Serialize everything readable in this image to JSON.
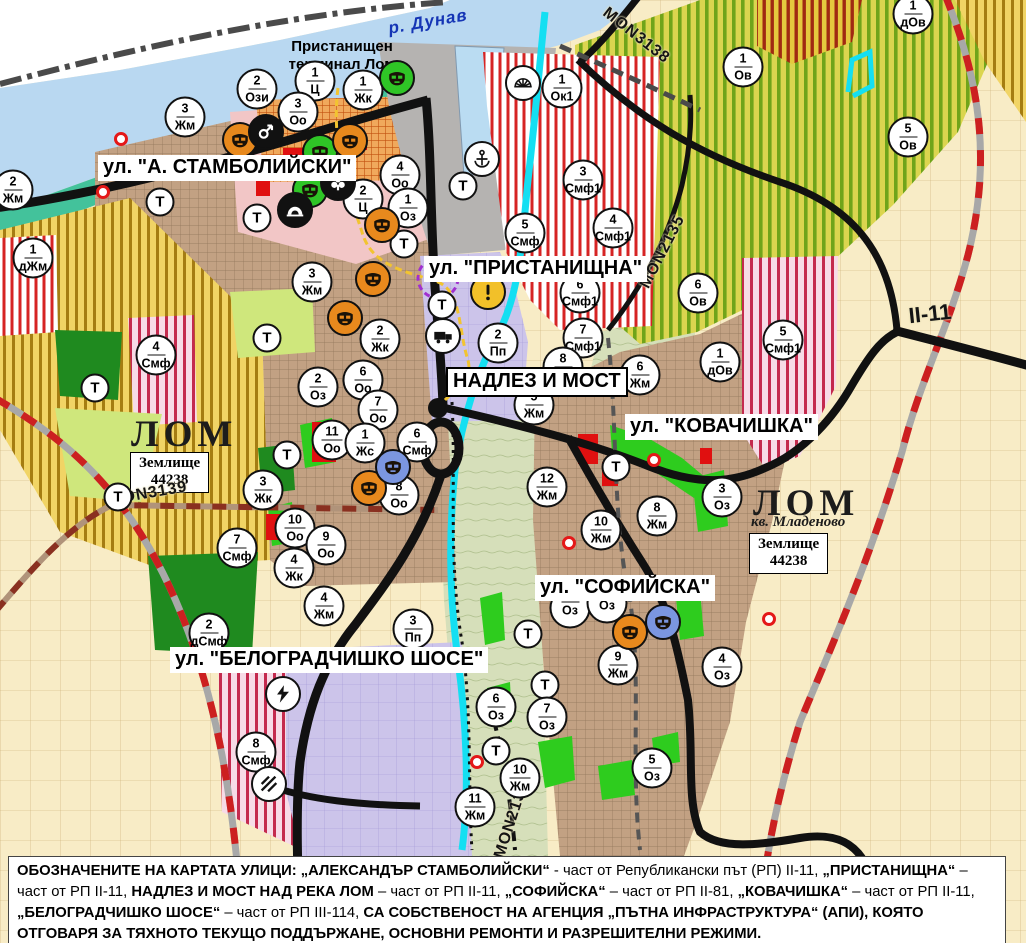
{
  "map": {
    "river_label": "р. Дунав",
    "port_terminal_label": "Пристанищен терминал Лом",
    "street_labels": [
      {
        "text": "ул. \"А. СТАМБОЛИЙСКИ\"",
        "x": 98,
        "y": 155,
        "boxed": false
      },
      {
        "text": "ул. \"ПРИСТАНИЩНА\"",
        "x": 424,
        "y": 256,
        "boxed": false
      },
      {
        "text": "НАДЛЕЗ И МОСТ",
        "x": 446,
        "y": 367,
        "boxed": true
      },
      {
        "text": "ул. \"КОВАЧИШКА\"",
        "x": 625,
        "y": 414,
        "boxed": false
      },
      {
        "text": "ул. \"СОФИЙСКА\"",
        "x": 535,
        "y": 575,
        "boxed": false
      },
      {
        "text": "ул. \"БЕЛОГРАДЧИШКО ШОСЕ\"",
        "x": 170,
        "y": 647,
        "boxed": false
      }
    ],
    "area_labels": [
      {
        "text": "ЛОМ",
        "x": 131,
        "y": 413
      },
      {
        "text": "ЛОМ",
        "x": 753,
        "y": 482
      }
    ],
    "sub_area_label": {
      "text": "кв. Младеново",
      "x": 751,
      "y": 514
    },
    "zemlishte_boxes": [
      {
        "line1": "Землище",
        "line2": "44238",
        "x": 130,
        "y": 452
      },
      {
        "line1": "Землище",
        "line2": "44238",
        "x": 749,
        "y": 533
      }
    ],
    "road_labels": [
      {
        "text": "MON3138",
        "x": 636,
        "y": 36,
        "rot": 38,
        "big": false
      },
      {
        "text": "MON2135",
        "x": 663,
        "y": 252,
        "rot": -63,
        "big": false
      },
      {
        "text": "MON3139",
        "x": 148,
        "y": 494,
        "rot": -10,
        "big": false
      },
      {
        "text": "MON2136",
        "x": 512,
        "y": 820,
        "rot": -72,
        "big": false
      },
      {
        "text": "II-11",
        "x": 930,
        "y": 314,
        "rot": -6,
        "big": true
      }
    ],
    "zone_markers": [
      {
        "n": "3",
        "c": "Жм",
        "x": 185,
        "y": 117
      },
      {
        "n": "2",
        "c": "Ози",
        "x": 257,
        "y": 89
      },
      {
        "n": "1",
        "c": "Ц",
        "x": 315,
        "y": 81
      },
      {
        "n": "3",
        "c": "Оо",
        "x": 298,
        "y": 112
      },
      {
        "n": "1",
        "c": "Жк",
        "x": 363,
        "y": 90
      },
      {
        "n": "4",
        "c": "Оо",
        "x": 400,
        "y": 175
      },
      {
        "n": "2",
        "c": "Ц",
        "x": 363,
        "y": 199
      },
      {
        "n": "1",
        "c": "Оз",
        "x": 408,
        "y": 208
      },
      {
        "n": "1",
        "c": "Ок1",
        "x": 562,
        "y": 88
      },
      {
        "n": "3",
        "c": "Смф1",
        "x": 583,
        "y": 180
      },
      {
        "n": "4",
        "c": "Смф1",
        "x": 613,
        "y": 228
      },
      {
        "n": "5",
        "c": "Смф",
        "x": 525,
        "y": 233
      },
      {
        "n": "6",
        "c": "Смф1",
        "x": 580,
        "y": 293
      },
      {
        "n": "7",
        "c": "Смф1",
        "x": 583,
        "y": 338
      },
      {
        "n": "2",
        "c": "Пп",
        "x": 498,
        "y": 343
      },
      {
        "n": "2",
        "c": "Жм",
        "x": 13,
        "y": 190
      },
      {
        "n": "1",
        "c": "дЖм",
        "x": 33,
        "y": 258
      },
      {
        "n": "4",
        "c": "Смф",
        "x": 156,
        "y": 355
      },
      {
        "n": "3",
        "c": "Жм",
        "x": 312,
        "y": 282
      },
      {
        "n": "2",
        "c": "Жк",
        "x": 380,
        "y": 339
      },
      {
        "n": "2",
        "c": "Оз",
        "x": 318,
        "y": 387
      },
      {
        "n": "6",
        "c": "Оо",
        "x": 363,
        "y": 380
      },
      {
        "n": "7",
        "c": "Оо",
        "x": 378,
        "y": 410
      },
      {
        "n": "11",
        "c": "Оо",
        "x": 332,
        "y": 440
      },
      {
        "n": "1",
        "c": "Жс",
        "x": 365,
        "y": 443
      },
      {
        "n": "6",
        "c": "Смф",
        "x": 417,
        "y": 442
      },
      {
        "n": "8",
        "c": "Оо",
        "x": 399,
        "y": 495
      },
      {
        "n": "3",
        "c": "Жк",
        "x": 263,
        "y": 490
      },
      {
        "n": "10",
        "c": "Оо",
        "x": 295,
        "y": 528
      },
      {
        "n": "9",
        "c": "Оо",
        "x": 326,
        "y": 545
      },
      {
        "n": "4",
        "c": "Жк",
        "x": 294,
        "y": 568
      },
      {
        "n": "7",
        "c": "Смф",
        "x": 237,
        "y": 548
      },
      {
        "n": "8",
        "c": "Жм",
        "x": 563,
        "y": 367
      },
      {
        "n": "5",
        "c": "Жм",
        "x": 534,
        "y": 405
      },
      {
        "n": "6",
        "c": "Жм",
        "x": 640,
        "y": 375
      },
      {
        "n": "12",
        "c": "Жм",
        "x": 547,
        "y": 487
      },
      {
        "n": "10",
        "c": "Жм",
        "x": 601,
        "y": 530
      },
      {
        "n": "8",
        "c": "Жм",
        "x": 657,
        "y": 516
      },
      {
        "n": "6",
        "c": "Ов",
        "x": 698,
        "y": 293
      },
      {
        "n": "5",
        "c": "Смф1",
        "x": 783,
        "y": 340
      },
      {
        "n": "1",
        "c": "дОв",
        "x": 720,
        "y": 362
      },
      {
        "n": "1",
        "c": "Ов",
        "x": 743,
        "y": 67
      },
      {
        "n": "5",
        "c": "Ов",
        "x": 908,
        "y": 137
      },
      {
        "n": "1",
        "c": "дОв",
        "x": 913,
        "y": 14
      },
      {
        "n": "3",
        "c": "Оз",
        "x": 722,
        "y": 497
      },
      {
        "n": "9",
        "c": "Жм",
        "x": 618,
        "y": 665
      },
      {
        "n": "4",
        "c": "Оз",
        "x": 722,
        "y": 667
      },
      {
        "n": "6",
        "c": "Оз",
        "x": 496,
        "y": 707
      },
      {
        "n": "7",
        "c": "Оз",
        "x": 547,
        "y": 717
      },
      {
        "n": "10",
        "c": "Жм",
        "x": 520,
        "y": 778
      },
      {
        "n": "11",
        "c": "Жм",
        "x": 475,
        "y": 807
      },
      {
        "n": "5",
        "c": "Оз",
        "x": 652,
        "y": 768
      },
      {
        "n": "2",
        "c": "дСмф",
        "x": 209,
        "y": 633
      },
      {
        "n": "4",
        "c": "Жм",
        "x": 324,
        "y": 606
      },
      {
        "n": "3",
        "c": "Пп",
        "x": 413,
        "y": 629
      },
      {
        "n": "8",
        "c": "Смф",
        "x": 256,
        "y": 752
      },
      {
        "n": "",
        "c": "Оз",
        "x": 570,
        "y": 608
      },
      {
        "n": "",
        "c": "Оз",
        "x": 607,
        "y": 603
      }
    ],
    "trafo_label": "Т",
    "trafo_markers": [
      {
        "x": 160,
        "y": 202
      },
      {
        "x": 257,
        "y": 218
      },
      {
        "x": 463,
        "y": 186
      },
      {
        "x": 404,
        "y": 244
      },
      {
        "x": 442,
        "y": 305
      },
      {
        "x": 267,
        "y": 338
      },
      {
        "x": 95,
        "y": 388
      },
      {
        "x": 287,
        "y": 455
      },
      {
        "x": 118,
        "y": 497
      },
      {
        "x": 616,
        "y": 467
      },
      {
        "x": 528,
        "y": 634
      },
      {
        "x": 545,
        "y": 685
      },
      {
        "x": 496,
        "y": 751
      }
    ],
    "icon_markers": [
      {
        "icon": "theater-mask-icon",
        "bg": "#2fc526",
        "x": 397,
        "y": 78
      },
      {
        "icon": "theater-mask-icon",
        "bg": "#2fc526",
        "x": 320,
        "y": 152
      },
      {
        "icon": "theater-mask-icon",
        "bg": "#2fc526",
        "x": 310,
        "y": 190
      },
      {
        "icon": "theater-mask-icon",
        "bg": "#e8891d",
        "x": 240,
        "y": 140
      },
      {
        "icon": "theater-mask-icon",
        "bg": "#e8891d",
        "x": 350,
        "y": 141
      },
      {
        "icon": "theater-mask-icon",
        "bg": "#e8891d",
        "x": 382,
        "y": 225
      },
      {
        "icon": "theater-mask-icon",
        "bg": "#e8891d",
        "x": 373,
        "y": 279
      },
      {
        "icon": "theater-mask-icon",
        "bg": "#e8891d",
        "x": 345,
        "y": 318
      },
      {
        "icon": "theater-mask-icon",
        "bg": "#e8891d",
        "x": 369,
        "y": 488
      },
      {
        "icon": "theater-mask-icon",
        "bg": "#e8891d",
        "x": 630,
        "y": 632
      },
      {
        "icon": "theater-mask-icon",
        "bg": "#7b96e0",
        "x": 393,
        "y": 467
      },
      {
        "icon": "theater-mask-icon",
        "bg": "#7b96e0",
        "x": 663,
        "y": 622
      },
      {
        "icon": "compass-arrow-icon",
        "bg": "#111111",
        "x": 266,
        "y": 132
      },
      {
        "icon": "trefoil-icon",
        "bg": "#111111",
        "x": 338,
        "y": 183
      },
      {
        "icon": "tunnel-icon",
        "bg": "#111111",
        "x": 295,
        "y": 210
      },
      {
        "icon": "anchor-icon",
        "bg": "#ffffff",
        "x": 482,
        "y": 159
      },
      {
        "icon": "fan-icon",
        "bg": "#ffffff",
        "x": 523,
        "y": 83
      },
      {
        "icon": "truck-icon",
        "bg": "#ffffff",
        "x": 443,
        "y": 336
      },
      {
        "icon": "warning-icon",
        "bg": "#f2c029",
        "x": 488,
        "y": 292
      },
      {
        "icon": "lightning-icon",
        "bg": "#ffffff",
        "x": 283,
        "y": 694
      },
      {
        "icon": "railway-crossing-icon",
        "bg": "#ffffff",
        "x": 269,
        "y": 784
      }
    ],
    "red_dots": [
      {
        "x": 121,
        "y": 139
      },
      {
        "x": 103,
        "y": 192
      },
      {
        "x": 654,
        "y": 460
      },
      {
        "x": 569,
        "y": 543
      },
      {
        "x": 477,
        "y": 762
      },
      {
        "x": 769,
        "y": 619
      }
    ],
    "colors": {
      "river": "#b9d8f1",
      "shoreline": "#43c29b",
      "urban": "#c2a183",
      "fields": "#f7ecc8",
      "park_green": "#1f8a1f",
      "oz_green": "#2ecc1e",
      "industrial_lavender": "#ccc4ea",
      "port_gray": "#b5b3b1",
      "smf_red": "#d62424",
      "road_black": "#111111",
      "rail_red": "#cc2020",
      "lom_river_cyan": "#14dff2"
    }
  },
  "footer": {
    "segments": [
      {
        "t": "ОБОЗНАЧЕНИТЕ НА КАРТАТА УЛИЦИ: „АЛЕКСАНДЪР СТАМБОЛИЙСКИ“",
        "b": true
      },
      {
        "t": " - част от Републикански път (РП) II-11, ",
        "b": false
      },
      {
        "t": "„ПРИСТАНИЩНА“",
        "b": true
      },
      {
        "t": " – част от РП II-11, ",
        "b": false
      },
      {
        "t": "НАДЛЕЗ И МОСТ НАД РЕКА ЛОМ",
        "b": true
      },
      {
        "t": " – част от РП II-11, ",
        "b": false
      },
      {
        "t": "„СОФИЙСКА“",
        "b": true
      },
      {
        "t": " – част от РП II-81, ",
        "b": false
      },
      {
        "t": "„КОВАЧИШКА“",
        "b": true
      },
      {
        "t": " – част от РП II-11, ",
        "b": false
      },
      {
        "t": "„БЕЛОГРАДЧИШКО ШОСЕ“",
        "b": true
      },
      {
        "t": " – част от РП III-114, ",
        "b": false
      },
      {
        "t": "СА СОБСТВЕНОСТ НА АГЕНЦИЯ „ПЪТНА ИНФРАСТРУКТУРА“ (АПИ), КОЯТО ОТГОВАРЯ ЗА ТЯХНОТО ТЕКУЩО ПОДДЪРЖАНЕ, ОСНОВНИ РЕМОНТИ И РАЗРЕШИТЕЛНИ РЕЖИМИ.",
        "b": true
      }
    ]
  }
}
